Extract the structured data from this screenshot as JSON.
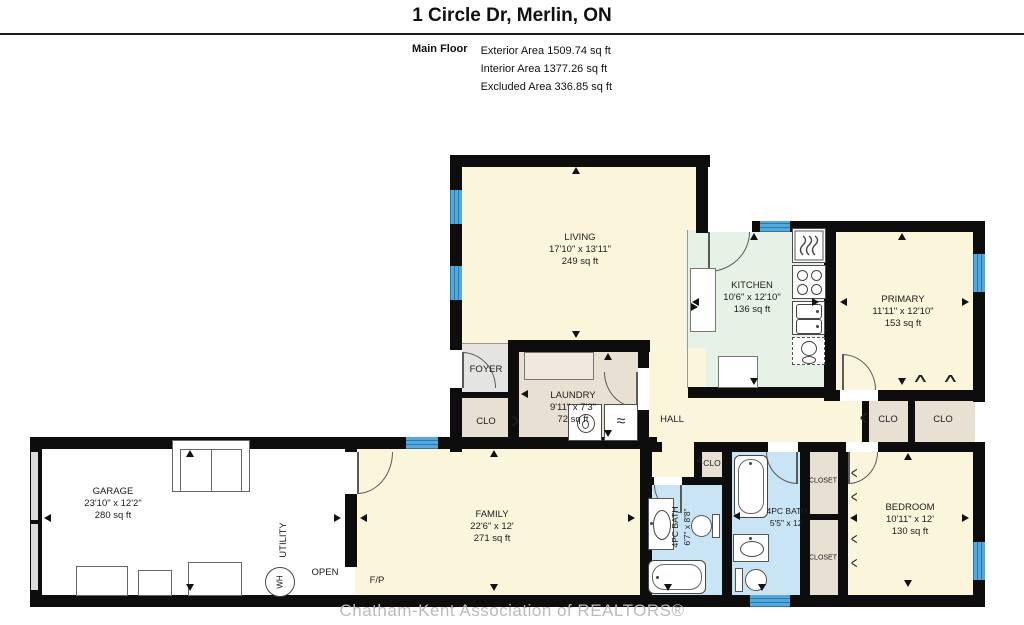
{
  "header": {
    "title": "1 Circle Dr, Merlin, ON",
    "floor_label": "Main Floor",
    "areas": [
      "Exterior Area 1509.74 sq ft",
      "Interior Area 1377.26 sq ft",
      "Excluded Area 336.85 sq ft"
    ]
  },
  "rooms": {
    "living": {
      "name": "LIVING",
      "dims": "17'10\" x 13'11\"",
      "area": "249 sq ft"
    },
    "kitchen": {
      "name": "KITCHEN",
      "dims": "10'6\" x 12'10\"",
      "area": "136 sq ft"
    },
    "primary": {
      "name": "PRIMARY",
      "dims": "11'11\" x 12'10\"",
      "area": "153 sq ft"
    },
    "laundry": {
      "name": "LAUNDRY",
      "dims": "9'11\" x 7'3\"",
      "area": "72 sq ft"
    },
    "garage": {
      "name": "GARAGE",
      "dims": "23'10\" x 12'2\"",
      "area": "280 sq ft"
    },
    "family": {
      "name": "FAMILY",
      "dims": "22'6\" x 12'",
      "area": "271 sq ft"
    },
    "bedroom": {
      "name": "BEDROOM",
      "dims": "10'11\" x 12'",
      "area": "130 sq ft"
    },
    "bath1": {
      "name": "4PC BATH",
      "dims": "6'7\" x 8'8\""
    },
    "bath2": {
      "name": "4PC BATH",
      "dims": "5'5\" x 12'"
    },
    "foyer": {
      "name": "FOYER"
    },
    "hall": {
      "name": "HALL"
    }
  },
  "labels": {
    "clo": "CLO",
    "closet": "CLOSET",
    "fp": "F/P",
    "utility": "UTILITY",
    "wh": "WH",
    "open": "OPEN"
  },
  "icons": {
    "dryer_wave": "≈",
    "bifold_left": "<",
    "bifold_right": ">",
    "bifold_up": "∧"
  },
  "colors": {
    "wall": "#0d0d0d",
    "room_cream": "#fbf5dc",
    "kitchen_green": "#e7f2e7",
    "closet_beige": "#e8e0d2",
    "foyer_gray": "#e4e4e2",
    "bath_blue": "#c8e4f5",
    "window_blue": "#55a8da",
    "garage_white": "#ffffff",
    "watermark_gray": "#b8bcbe"
  },
  "watermark": "Chatham-Kent Association of REALTORS®"
}
